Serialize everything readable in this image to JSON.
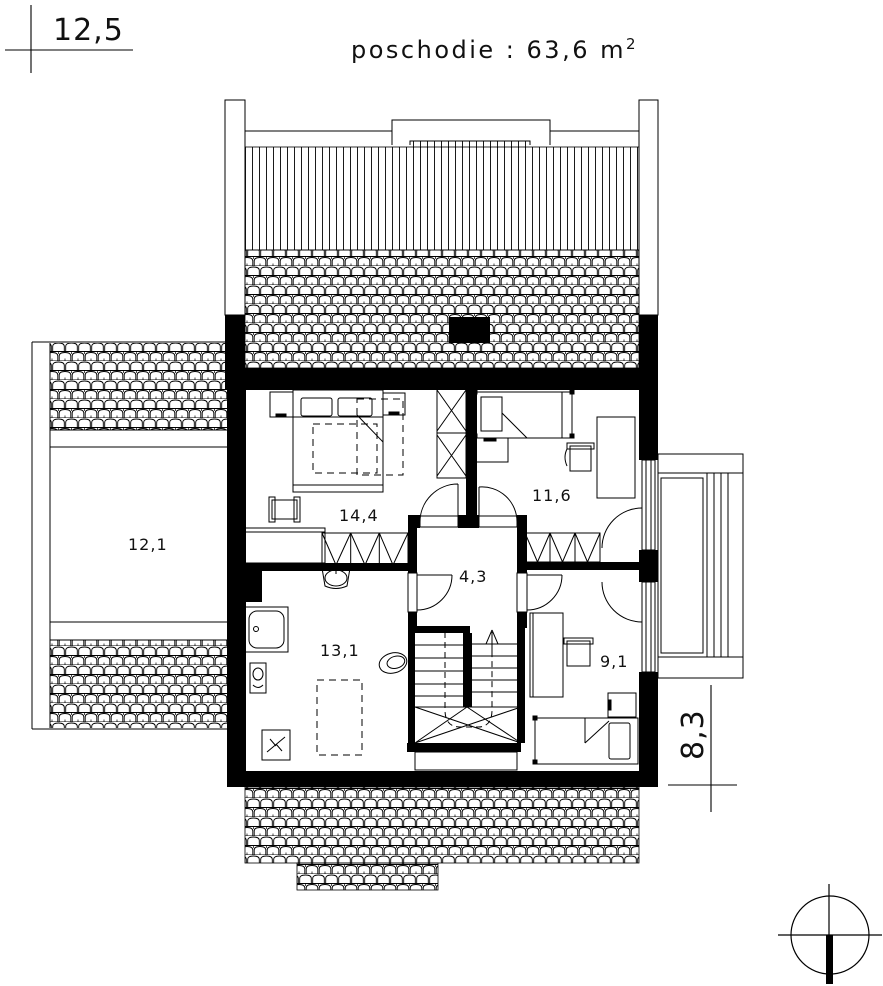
{
  "title": {
    "main": "poschodie : 63,6 m",
    "sup": "2"
  },
  "dimensions": {
    "width_label": "12,5",
    "height_label": "8,3"
  },
  "rooms": [
    {
      "id": "room-12-1",
      "label": "12,1"
    },
    {
      "id": "room-14-4",
      "label": "14,4"
    },
    {
      "id": "room-11-6",
      "label": "11,6"
    },
    {
      "id": "room-4-3",
      "label": "4,3"
    },
    {
      "id": "room-13-1",
      "label": "13,1"
    },
    {
      "id": "room-9-1",
      "label": "9,1"
    }
  ],
  "colors": {
    "ink": "#000000",
    "paper": "#ffffff"
  }
}
